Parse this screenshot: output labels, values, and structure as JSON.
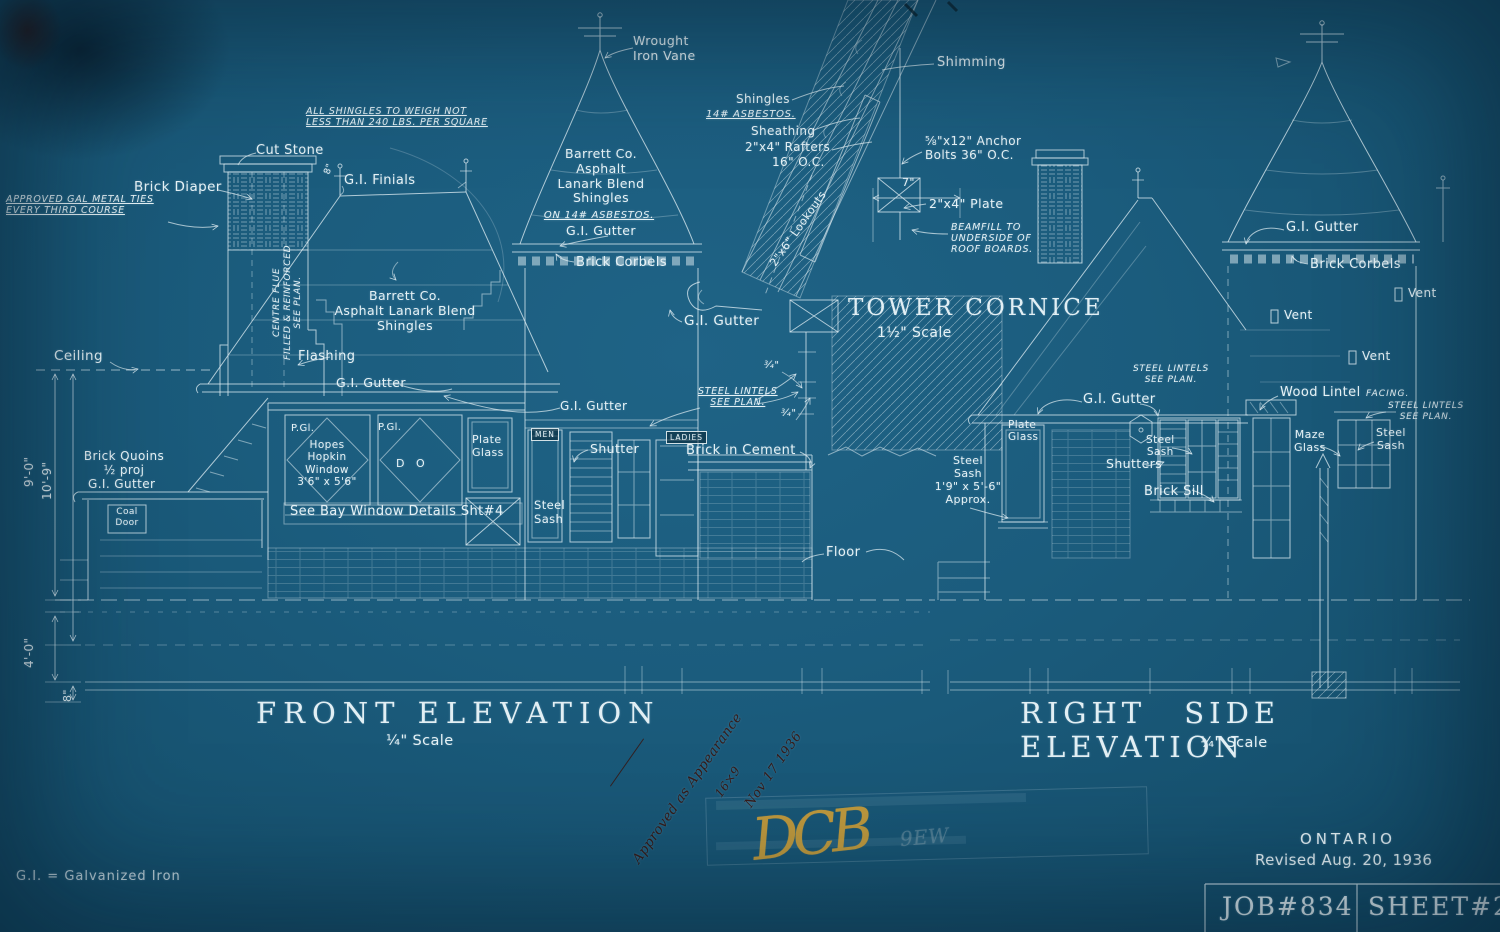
{
  "titles": {
    "front": "FRONT ELEVATION",
    "right": "RIGHT SIDE ELEVATION",
    "quarter_scale": "¼\" Scale",
    "cornice": "TOWER CORNICE",
    "cornice_scale": "1½\" Scale"
  },
  "title_block": {
    "region": "ONTARIO",
    "revised": "Revised Aug. 20, 1936",
    "job": "JOB#834",
    "sheet": "SHEET#2"
  },
  "legend": {
    "gi": "G.I. = Galvanized Iron"
  },
  "ann": {
    "wrought_vane": "Wrought\nIron Vane",
    "shimming": "Shimming",
    "shingles": "Shingles",
    "asbestos14": "14# ASBESTOS.",
    "sheathing": "Sheathing",
    "rafters": "2\"x4\" Rafters",
    "oc16": "16\" O.C.",
    "anchor": "⅝\"x12\" Anchor\nBolts 36\" O.C.",
    "plate24": "2\"x4\" Plate",
    "beamfill": "BEAMFILL TO\nUNDERSIDE OF\nROOF BOARDS.",
    "shingle_note": "ALL SHINGLES TO WEIGH NOT\nLESS THAN 240 LBS. PER SQUARE",
    "cut_stone": "Cut Stone",
    "brick_diaper": "Brick Diaper",
    "metal_ties": "APPROVED GAL METAL TIES\nEVERY THIRD COURSE",
    "gi_finials": "G.I. Finials",
    "centre_flue": "CENTRE FLUE\nFILLED & REINFORCED\nSEE PLAN.",
    "barrett_tower": "Barrett Co.\nAsphalt\nLanark Blend\nShingles",
    "on_asbestos": "ON 14# ASBESTOS.",
    "gi_gutter": "G.I. Gutter",
    "brick_corbels": "Brick Corbels",
    "barrett_main": "Barrett Co.\nAsphalt Lanark Blend\nShingles",
    "ceiling": "Ceiling",
    "flashing": "Flashing",
    "lookouts": "2\"x6\" Lookouts",
    "lintels": "STEEL LINTELS\nSEE PLAN.",
    "men": "MEN",
    "ladies": "LADIES",
    "shutter": "Shutter",
    "brick_cement": "Brick in Cement",
    "steel_sash_sm": "Steel\nSash",
    "pgl": "P.Gl.",
    "hopes": "Hopes\nHopkin\nWindow\n3'6\" x 5'6\"",
    "ditto": "D O",
    "plate_glass": "Plate\nGlass",
    "bay_note": "See Bay Window Details Sht#4",
    "quoins": "Brick Quoins\n½ proj",
    "coal_door": "Coal\nDoor",
    "floor": "Floor",
    "sash_approx": "Steel\nSash\n1'9\" x 5'-6\"\nApprox.",
    "shutters_r": "Shutters",
    "brick_sill": "Brick Sill",
    "wood_lintel": "Wood Lintel",
    "facing": "FACING.",
    "maze_glass": "Maze\nGlass",
    "vent": "Vent"
  },
  "dims": {
    "seven": "7\"",
    "three_quarter": "¾\"",
    "eight_small": "8\"",
    "nine_ft": "9'-0\"",
    "ten_nine": "10'-9\"",
    "four_ft": "4'-0\"",
    "eight_in": "8\""
  },
  "handwriting": {
    "line1": "Approved as Appearance",
    "line2": "16×9",
    "line3": "Nov 17 1936",
    "monogram": "DCB",
    "initials": "9EW"
  },
  "colors": {
    "background": "#1b5c7d",
    "line": "#e2eff4",
    "ink": "#3a130c",
    "gold": "#d9a436"
  }
}
